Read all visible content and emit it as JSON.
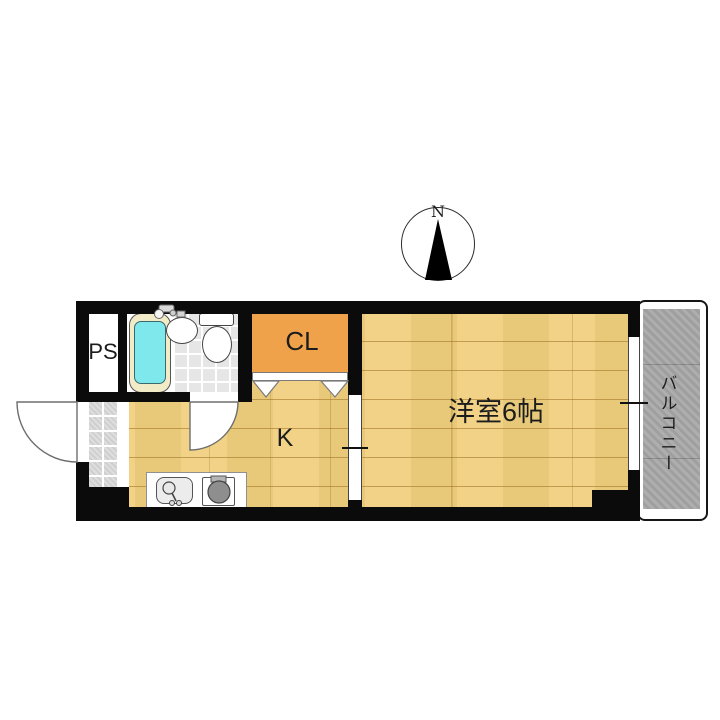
{
  "compass": {
    "label": "N"
  },
  "rooms": {
    "ps": {
      "label": "PS"
    },
    "closet": {
      "label": "CL"
    },
    "kitchen": {
      "label": "K",
      "fixtures": [
        "kitchen-sink",
        "stove"
      ]
    },
    "western_room": {
      "label": "洋室6帖"
    },
    "balcony": {
      "label": "バルコニー"
    },
    "bathroom": {
      "fixtures": [
        "bathtub",
        "washbasin",
        "toilet"
      ]
    },
    "entrance": {
      "fixtures": [
        "entrance-door"
      ]
    }
  },
  "colors": {
    "wall": "#0b0b0b",
    "wood": "#f0cf7e",
    "closet": "#f0a24a",
    "tub_water": "#7fe8ec",
    "tub_rim": "#f2ebc8",
    "balcony": "#a9a9a9",
    "tile": "#e2e2e2"
  }
}
